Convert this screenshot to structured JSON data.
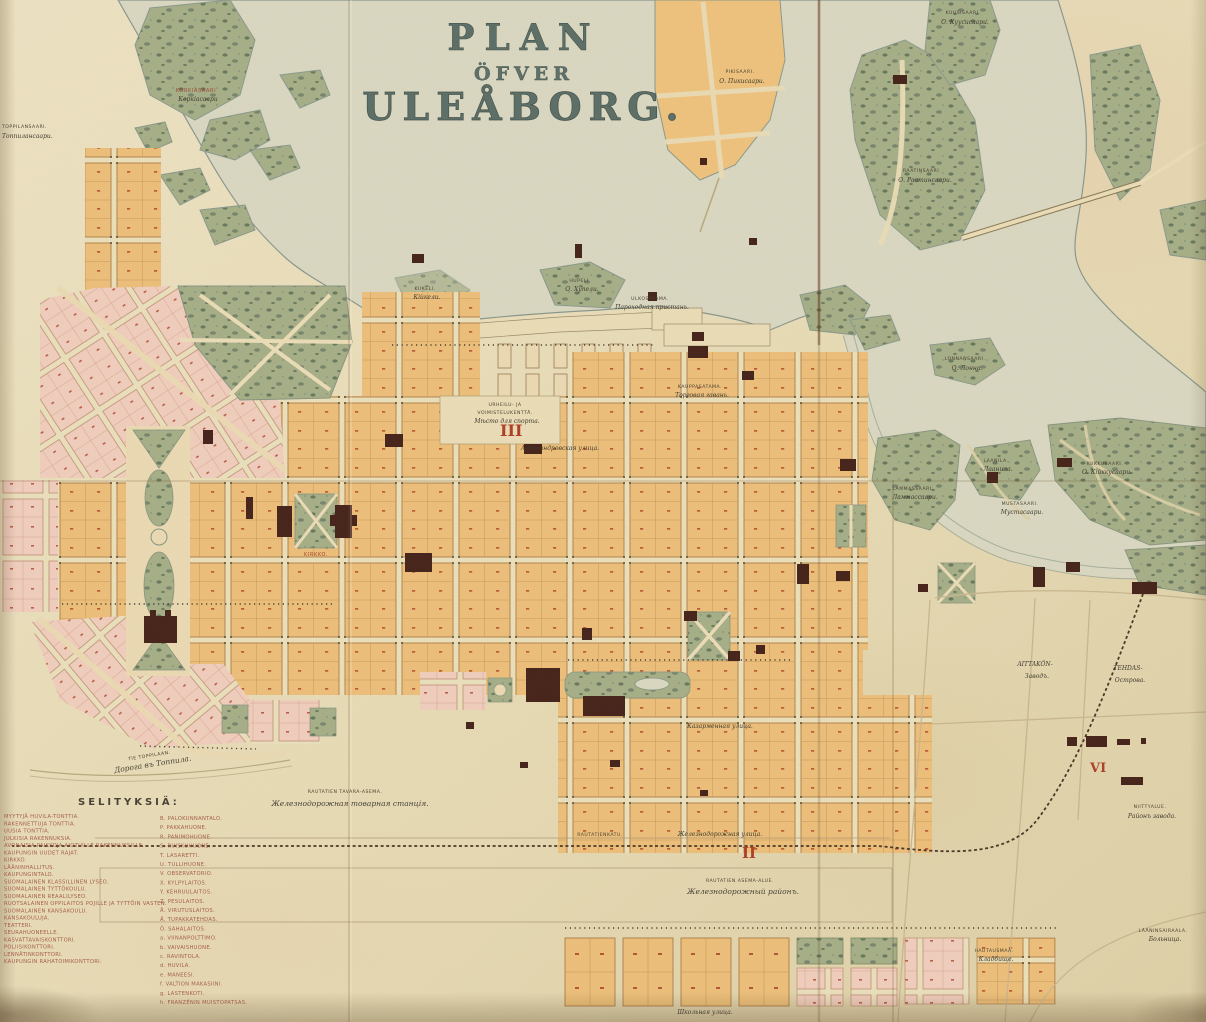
{
  "title": {
    "line1": "PLAN",
    "line2": "ÖFVER",
    "line3": "ULEÅBORG."
  },
  "districts": [
    {
      "numeral": "III"
    },
    {
      "numeral": "II"
    },
    {
      "numeral": "VI"
    }
  ],
  "legend": {
    "heading": "SELITYKSIÄ:",
    "col1": [
      "MYYTYJÄ HUVILA-TONTTIA.",
      "RAKENNETTUJA TONTTIA.",
      "UUSIA TONTTIA.",
      "JULKISIA RAKENNUKSIA.",
      "AVONAISIA PAIKKOJA AIOTUILLE RAKENNUKSILLE.",
      "KAUPUNGIN UUDET RAJAT.",
      "KIRKKO.",
      "LÄÄNINHALLITUS.",
      "KAUPUNGINTALO.",
      "SUOMALAINEN KLASSILLINEN LYSEO.",
      "SUOMALAINEN TYTTÖKOULU.",
      "SUOMALAINEN REAALILYSEO.",
      "RUOTSALAINEN OPPILAITOS POJILLE JA TYTTÖIN VASTEN.",
      "SUOMALAINEN KANSAKOULU.",
      "KANSAKOULUJA.",
      "TEATTERI.",
      "SEURAHUONEELLE.",
      "KASVATTAVAISKONTTORI.",
      "POLIISIKONTTORI.",
      "LENNÄTINKONTTORI.",
      "KAUPUNGIN RAHATOIMIKONTTORI."
    ],
    "col2": [
      "B. PALOKUNNANTALO.",
      "P. PAKKAHUONE.",
      "R. PANIMOHUONE.",
      "S. RUISKUHUONE.",
      "T. LASARETTI.",
      "U. TULLIHUONE.",
      "V. OBSERVATORIO.",
      "X. KYLPYLAITOS.",
      "Y. KEHRUULAITOS.",
      "Z. PESULAITOS.",
      "Å. VIRUTUSLAITOS.",
      "Ä. TUPAKKATEHDAS.",
      "Ö. SAHALAITOS.",
      "a. VIINANPOLTTIMO.",
      "b. VAIVAISHUONE.",
      "c. RAVINTOLA.",
      "d. HUVILA.",
      "e. MANEESI.",
      "f. VALTION MAKASIINI.",
      "g. LASTENKOTI.",
      "h. FRANZÉNIN MUISTOPATSAS."
    ]
  },
  "map_labels": {
    "toppilansaari_fi": "TOPPILANSAARI.",
    "toppilansaari_ru": "Топпилансаари.",
    "korkiasaari_fi": "KORKIASAARI",
    "korkiasaari_ru": "Коркiасаари",
    "pikisaari_fi": "PIKISAARI.",
    "pikisaari_ru": "О. Пикисаари.",
    "raatinsaari_fi": "RAATINSAARI.",
    "raatinsaari_ru": "О. Раатинсаари.",
    "kuusisaari_fi": "KUUSISAARI.",
    "kuusisaari_ru": "О. Куусисаари.",
    "lonnansaari_fi": "LONNANSAARI.",
    "lonnansaari_ru": "О. Лонна.",
    "kiikeli_fi": "KIIKELI.",
    "kiikeli_ru": "Кійкели.",
    "hupeli_fi": "HUPELI.",
    "hupeli_ru": "О. Хупели.",
    "lammassaari_fi": "LAMMASSAARI.",
    "lammassaari_ru": "Ламмассаари.",
    "laanila_fi": "LAANILA.",
    "laanila_ru": "Лаанила.",
    "mustasaari_fi": "MUSTASAARI.",
    "mustasaari_ru": "Мустасаари.",
    "kiikkusaari_fi": "KIIKKUSAARI.",
    "kiikkusaari_ru": "О. Кійккусаари.",
    "ulkosatama_fi": "ULKOSATAMA.",
    "ulkosatama_ru": "Пароходная пристань.",
    "kauppasatama_fi": "KAUPPASATAMA.",
    "kauppasatama_ru": "Торговая гавань.",
    "sports_fi1": "URHEILU- JA",
    "sports_fi2": "VOIMISTELUKENTTÄ.",
    "sports_ru": "Мѣсто для спорта.",
    "kirkko": "KIRKKO.",
    "aleksandrovskaya": "Александровская улица.",
    "kazarmennaya": "Казарменная улица.",
    "rautatienkatu": "RAUTATIENKATU.",
    "zheleznaya_ul": "Железнодорожная улица.",
    "tavara_fi": "RAUTATIEN TAVARA-ASEMA.",
    "tavara_ru": "Железнодорожная товарная станцiя.",
    "area_fi": "RAUTATIEN ASEMA-ALUE.",
    "area_ru": "Железнодорожный районъ.",
    "fields_a_fi": "AITTAKÖN-",
    "fields_a_ru": "Заводъ.",
    "fields_b_fi": "TEHDAS-",
    "fields_b_ru": "Острова.",
    "never_fi": "NIITTYALUE.",
    "never_ru": "Районъ завода.",
    "cemetery_fi": "HAUTAUSMAA.",
    "cemetery_ru": "Кладбище.",
    "hospital_fi": "LÄÄNINSAIRAALA.",
    "hospital_ru": "Больница.",
    "toppila_road_fi": "TIE TOPPILAAN.",
    "toppila_road_ru": "Дорога въ Топпила.",
    "shkolnaya": "Школьная улица."
  },
  "palette": {
    "paper": "#e8dcba",
    "water": "#d9d7c1",
    "block_orange": "#ecbf7a",
    "block_pink": "#f0cdbd",
    "park_green": "#a9b089",
    "building_dark": "#45231a",
    "accent_red": "#ae4129",
    "title_ink": "#5e6f67"
  }
}
